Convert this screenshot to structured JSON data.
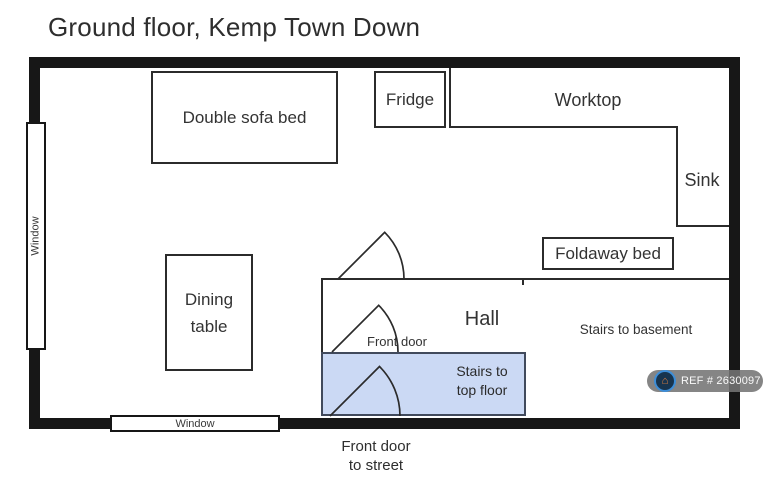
{
  "title": "Ground floor, Kemp Town Down",
  "rooms": {
    "double_sofa_bed": "Double sofa bed",
    "fridge": "Fridge",
    "worktop": "Worktop",
    "sink": "Sink",
    "foldaway_bed": "Foldaway bed",
    "dining_table": "Dining table",
    "hall": "Hall",
    "stairs_basement": "Stairs to basement",
    "stairs_top_line1": "Stairs to",
    "stairs_top_line2": "top floor",
    "front_door": "Front door",
    "front_door_street_line1": "Front door",
    "front_door_street_line2": "to street",
    "window": "Window"
  },
  "badge": {
    "ref": "REF # 2630097",
    "icon": "house-icon"
  },
  "colors": {
    "wall": "#171717",
    "interior_line": "#2b2b2b",
    "stairs_fill": "#cbd9f4",
    "stairs_border": "#414a5c",
    "badge_background": "#747474",
    "badge_icon_blue": "#3d8ed8",
    "badge_icon_navy": "#17344e",
    "badge_icon_orange": "#e8823d"
  }
}
